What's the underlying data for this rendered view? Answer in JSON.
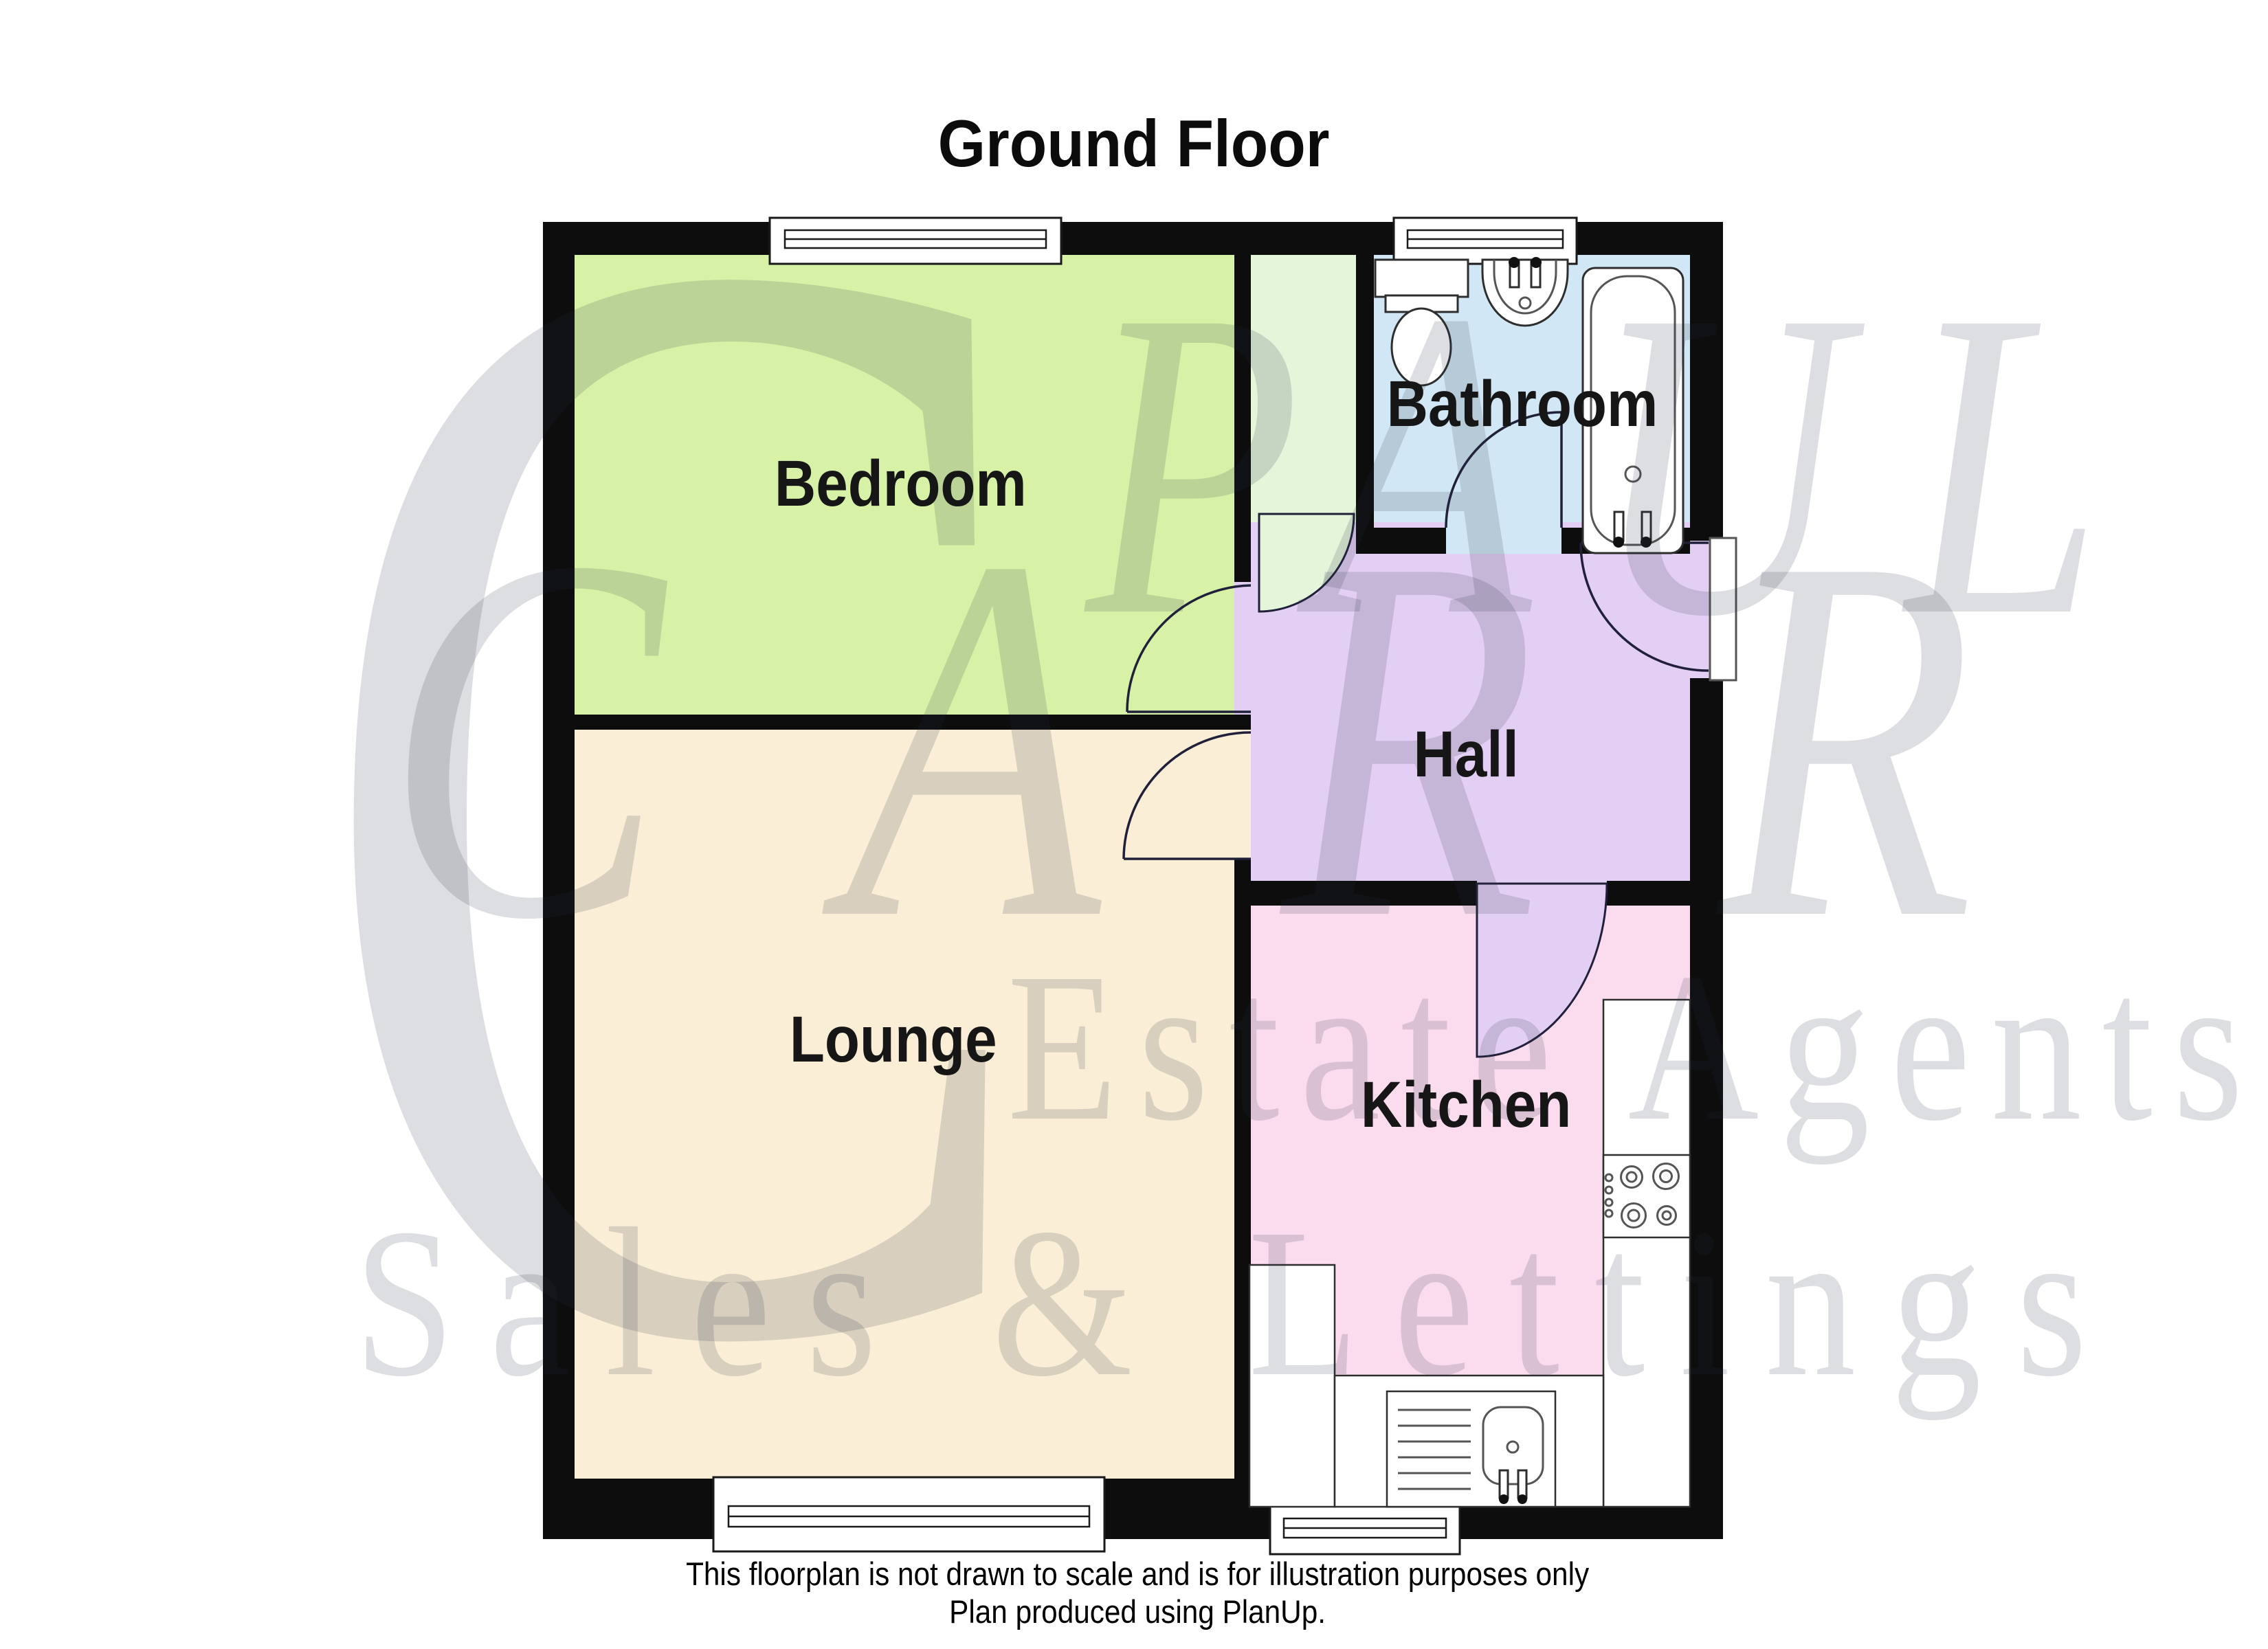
{
  "title": "Ground Floor",
  "rooms": {
    "bedroom": {
      "label": "Bedroom"
    },
    "bathroom": {
      "label": "Bathroom"
    },
    "hall": {
      "label": "Hall"
    },
    "lounge": {
      "label": "Lounge"
    },
    "kitchen": {
      "label": "Kitchen"
    },
    "cupboard": {
      "label": ""
    }
  },
  "colors": {
    "bedroom": "#d7f2a7",
    "cupboard": "#e4f5da",
    "bathroom": "#d2e7f5",
    "hall": "#e3cef4",
    "lounge": "#faeed7",
    "kitchen": "#fbdcee",
    "wall": "#0d0d0d"
  },
  "watermark": {
    "letter": "C",
    "line1": "PAUL",
    "line2": "CARR",
    "line3": "Estate Agents",
    "line4": "Sales & Lettings"
  },
  "footer": {
    "line1": "This floorplan is not drawn to scale and is for illustration purposes only",
    "line2": "Plan produced using PlanUp."
  },
  "fixtures": [
    "toilet",
    "basin",
    "bath",
    "hob",
    "sink-drainer"
  ]
}
